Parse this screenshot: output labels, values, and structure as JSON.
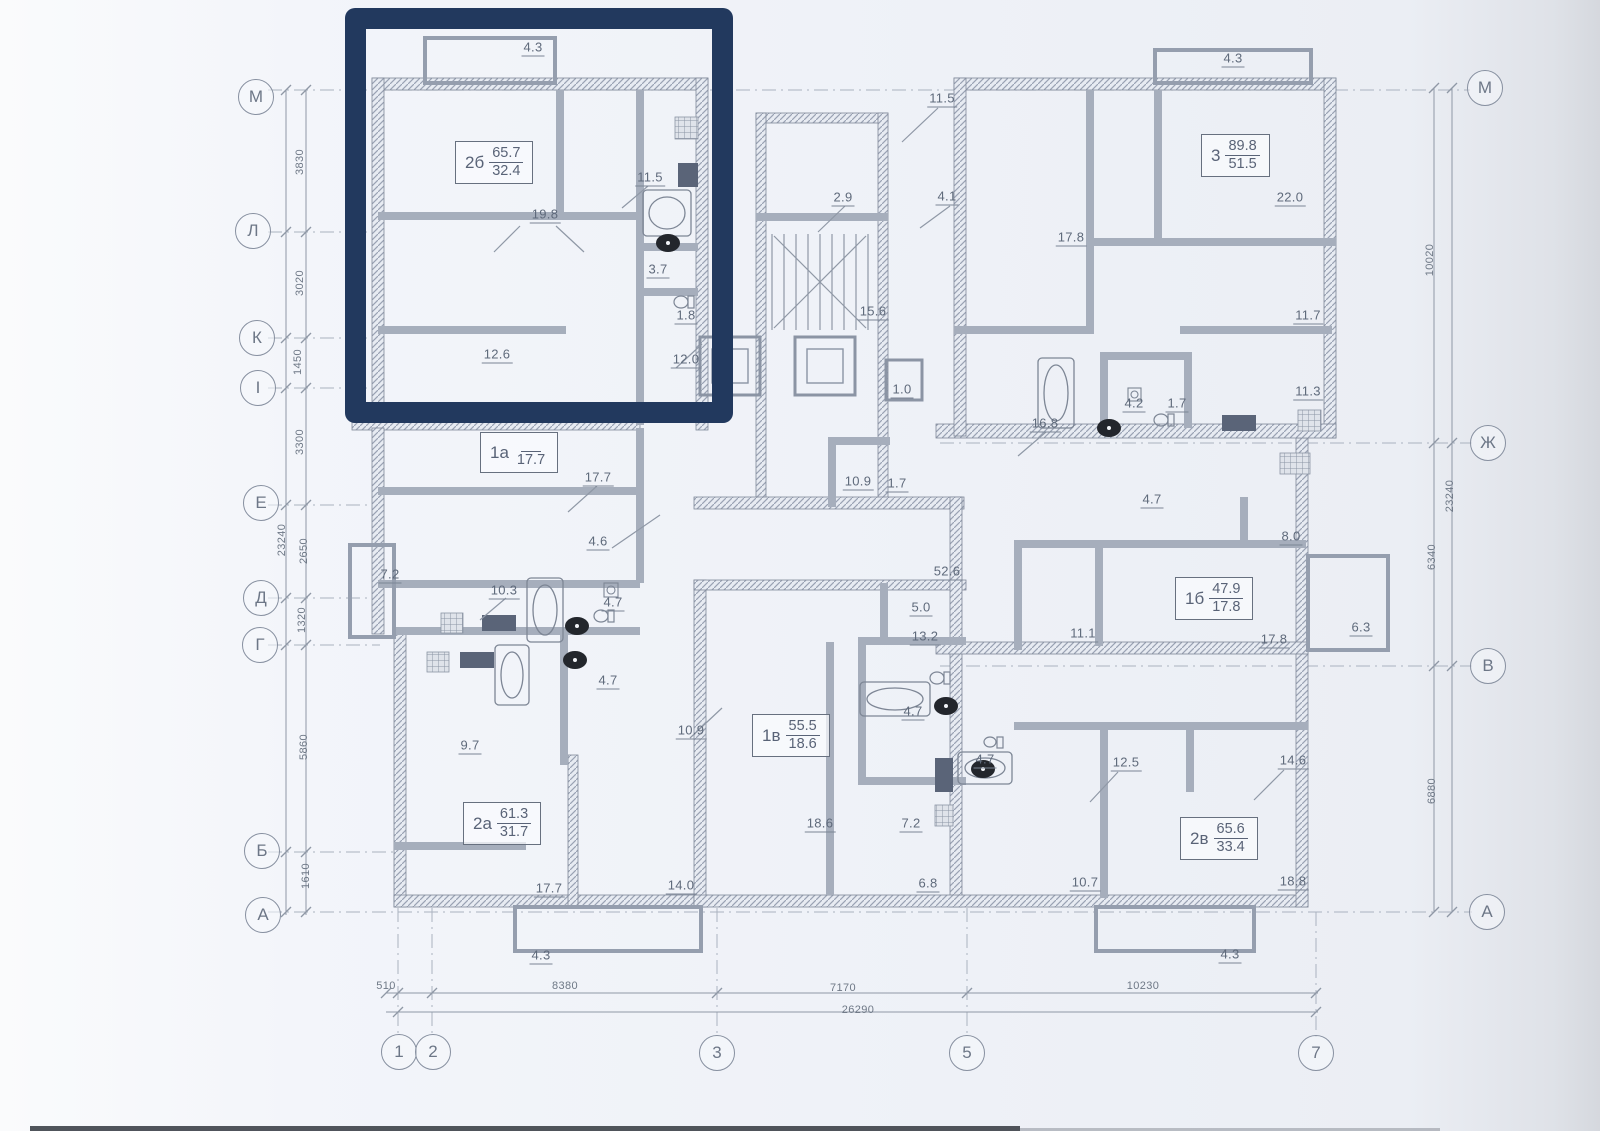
{
  "highlight": {
    "color": "#22395e"
  },
  "axes": {
    "left": [
      {
        "label": "М",
        "x": 256,
        "y": 97
      },
      {
        "label": "Л",
        "x": 253,
        "y": 231
      },
      {
        "label": "К",
        "x": 257,
        "y": 338
      },
      {
        "label": "I",
        "x": 258,
        "y": 388
      },
      {
        "label": "Е",
        "x": 261,
        "y": 503
      },
      {
        "label": "Д",
        "x": 261,
        "y": 598
      },
      {
        "label": "Г",
        "x": 260,
        "y": 645
      },
      {
        "label": "Б",
        "x": 262,
        "y": 851
      },
      {
        "label": "А",
        "x": 263,
        "y": 915
      }
    ],
    "right": [
      {
        "label": "М",
        "x": 1485,
        "y": 88
      },
      {
        "label": "Ж",
        "x": 1488,
        "y": 443
      },
      {
        "label": "В",
        "x": 1488,
        "y": 666
      },
      {
        "label": "А",
        "x": 1487,
        "y": 912
      }
    ],
    "bottom": [
      {
        "label": "1",
        "x": 399,
        "y": 1052
      },
      {
        "label": "2",
        "x": 433,
        "y": 1052
      },
      {
        "label": "3",
        "x": 717,
        "y": 1053
      },
      {
        "label": "5",
        "x": 967,
        "y": 1053
      },
      {
        "label": "7",
        "x": 1316,
        "y": 1053
      }
    ]
  },
  "dimensions": [
    {
      "text": "3830",
      "x": 300,
      "y": 162,
      "cls": "rot"
    },
    {
      "text": "3020",
      "x": 300,
      "y": 283,
      "cls": "rot"
    },
    {
      "text": "1450",
      "x": 298,
      "y": 362,
      "cls": "rot"
    },
    {
      "text": "3300",
      "x": 300,
      "y": 442,
      "cls": "rot"
    },
    {
      "text": "23240",
      "x": 282,
      "y": 540,
      "cls": "rot"
    },
    {
      "text": "2650",
      "x": 304,
      "y": 551,
      "cls": "rot"
    },
    {
      "text": "1320",
      "x": 302,
      "y": 620,
      "cls": "rot"
    },
    {
      "text": "5860",
      "x": 304,
      "y": 747,
      "cls": "rot"
    },
    {
      "text": "1610",
      "x": 306,
      "y": 876,
      "cls": "rot"
    },
    {
      "text": "10020",
      "x": 1430,
      "y": 260,
      "cls": "rot"
    },
    {
      "text": "23240",
      "x": 1450,
      "y": 496,
      "cls": "rot"
    },
    {
      "text": "6340",
      "x": 1432,
      "y": 557,
      "cls": "rot"
    },
    {
      "text": "6880",
      "x": 1432,
      "y": 791,
      "cls": "rot"
    },
    {
      "text": "510",
      "x": 386,
      "y": 986
    },
    {
      "text": "8380",
      "x": 565,
      "y": 986
    },
    {
      "text": "7170",
      "x": 843,
      "y": 988
    },
    {
      "text": "10230",
      "x": 1143,
      "y": 986
    },
    {
      "text": "26290",
      "x": 858,
      "y": 1010
    }
  ],
  "apartments": [
    {
      "name": "2б",
      "area_total": "65.7",
      "area_living": "32.4",
      "x": 455,
      "y": 141
    },
    {
      "name": "3",
      "area_total": "89.8",
      "area_living": "51.5",
      "x": 1201,
      "y": 134
    },
    {
      "name": "1а",
      "area_total": "",
      "area_living": "17.7",
      "x": 480,
      "y": 432
    },
    {
      "name": "1б",
      "area_total": "47.9",
      "area_living": "17.8",
      "x": 1175,
      "y": 577
    },
    {
      "name": "2а",
      "area_total": "61.3",
      "area_living": "31.7",
      "x": 463,
      "y": 802
    },
    {
      "name": "1в",
      "area_total": "55.5",
      "area_living": "18.6",
      "x": 752,
      "y": 714
    },
    {
      "name": "2в",
      "area_total": "65.6",
      "area_living": "33.4",
      "x": 1180,
      "y": 817
    }
  ],
  "rooms": [
    {
      "area": "4.3",
      "x": 533,
      "y": 48
    },
    {
      "area": "11.5",
      "x": 650,
      "y": 178
    },
    {
      "area": "19.8",
      "x": 545,
      "y": 215
    },
    {
      "area": "3.7",
      "x": 658,
      "y": 270
    },
    {
      "area": "1.8",
      "x": 686,
      "y": 316
    },
    {
      "area": "12.6",
      "x": 497,
      "y": 355
    },
    {
      "area": "12.0",
      "x": 686,
      "y": 360
    },
    {
      "area": "11.5",
      "x": 942,
      "y": 99
    },
    {
      "area": "2.9",
      "x": 843,
      "y": 198
    },
    {
      "area": "4.1",
      "x": 947,
      "y": 197
    },
    {
      "area": "15.6",
      "x": 873,
      "y": 312
    },
    {
      "area": "1.0",
      "x": 902,
      "y": 390
    },
    {
      "area": "10.9",
      "x": 858,
      "y": 482
    },
    {
      "area": "1.7",
      "x": 897,
      "y": 484
    },
    {
      "area": "4.3",
      "x": 1233,
      "y": 59
    },
    {
      "area": "17.8",
      "x": 1071,
      "y": 238
    },
    {
      "area": "22.0",
      "x": 1290,
      "y": 198
    },
    {
      "area": "11.7",
      "x": 1308,
      "y": 316
    },
    {
      "area": "11.3",
      "x": 1308,
      "y": 392
    },
    {
      "area": "16.8",
      "x": 1045,
      "y": 424
    },
    {
      "area": "4.2",
      "x": 1134,
      "y": 404
    },
    {
      "area": "1.7",
      "x": 1177,
      "y": 404
    },
    {
      "area": "4.7",
      "x": 1152,
      "y": 500
    },
    {
      "area": "8.0",
      "x": 1291,
      "y": 537
    },
    {
      "area": "11.1",
      "x": 1083,
      "y": 634
    },
    {
      "area": "17.8",
      "x": 1274,
      "y": 640
    },
    {
      "area": "6.3",
      "x": 1361,
      "y": 628
    },
    {
      "area": "52.6",
      "x": 947,
      "y": 572
    },
    {
      "area": "5.0",
      "x": 921,
      "y": 608
    },
    {
      "area": "13.2",
      "x": 925,
      "y": 637
    },
    {
      "area": "4.7",
      "x": 913,
      "y": 712
    },
    {
      "area": "4.7",
      "x": 985,
      "y": 760
    },
    {
      "area": "18.6",
      "x": 820,
      "y": 824
    },
    {
      "area": "7.2",
      "x": 911,
      "y": 824
    },
    {
      "area": "6.8",
      "x": 928,
      "y": 884
    },
    {
      "area": "7.2",
      "x": 390,
      "y": 575
    },
    {
      "area": "10.3",
      "x": 504,
      "y": 591
    },
    {
      "area": "4.7",
      "x": 613,
      "y": 603
    },
    {
      "area": "4.7",
      "x": 608,
      "y": 681
    },
    {
      "area": "4.6",
      "x": 598,
      "y": 542
    },
    {
      "area": "17.7",
      "x": 598,
      "y": 478
    },
    {
      "area": "9.7",
      "x": 470,
      "y": 746
    },
    {
      "area": "10.9",
      "x": 691,
      "y": 731
    },
    {
      "area": "17.7",
      "x": 549,
      "y": 889
    },
    {
      "area": "14.0",
      "x": 681,
      "y": 886
    },
    {
      "area": "4.3",
      "x": 541,
      "y": 956
    },
    {
      "area": "12.5",
      "x": 1126,
      "y": 763
    },
    {
      "area": "14.6",
      "x": 1293,
      "y": 761
    },
    {
      "area": "10.7",
      "x": 1085,
      "y": 883
    },
    {
      "area": "18.8",
      "x": 1293,
      "y": 882
    },
    {
      "area": "4.3",
      "x": 1230,
      "y": 955
    }
  ]
}
